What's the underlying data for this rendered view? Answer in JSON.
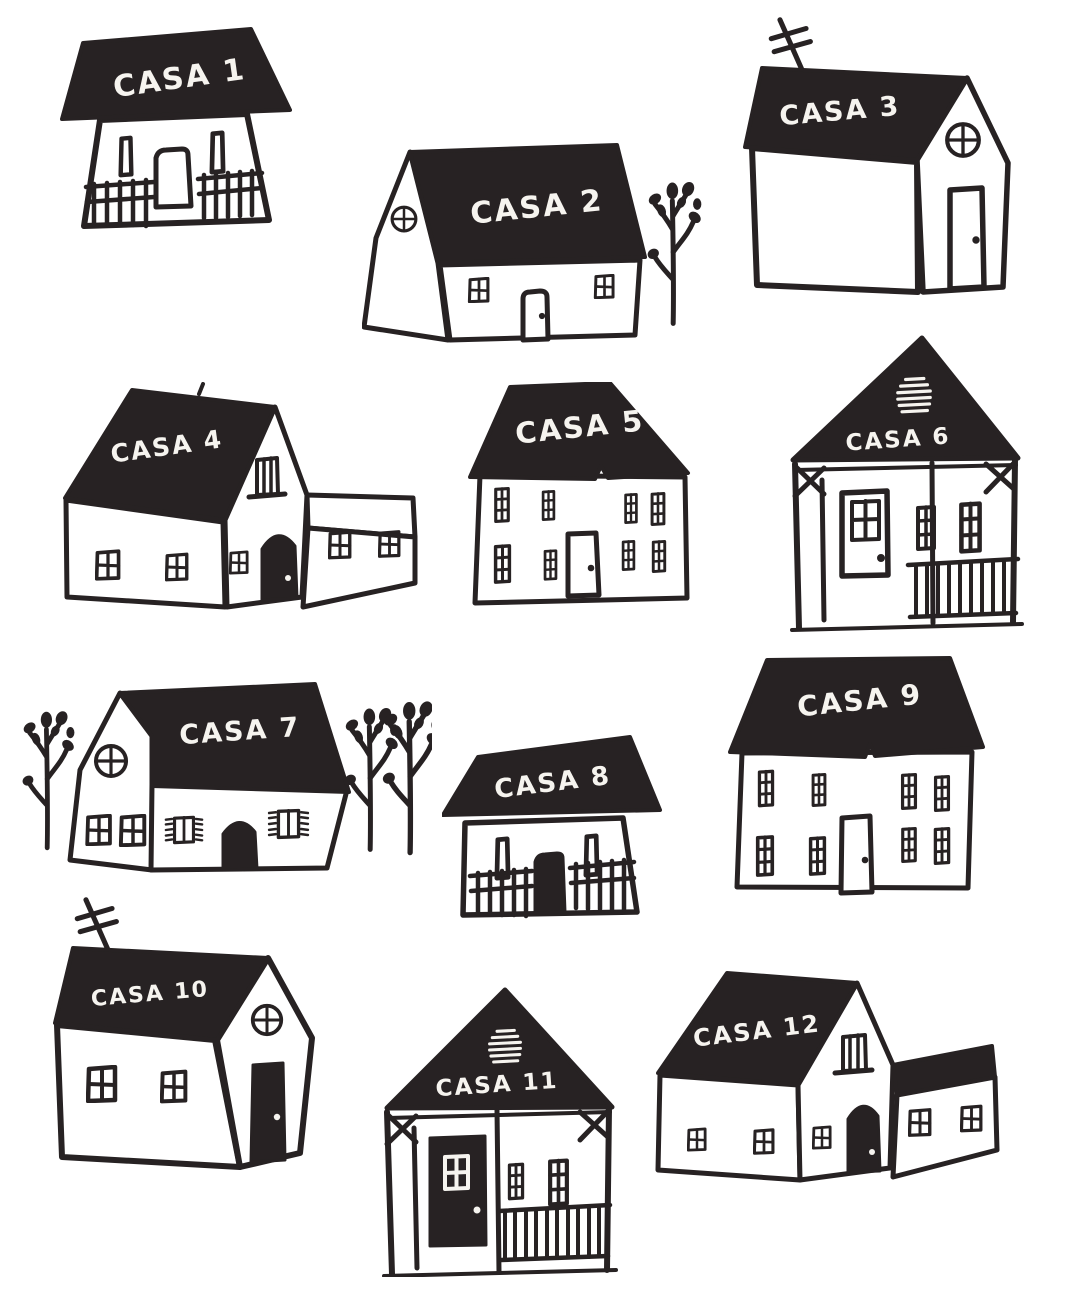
{
  "page": {
    "title": "Hand-drawn houses illustration sheet",
    "background": "#ffffff",
    "ink_color": "#272223",
    "label_color": "#f6f4ef"
  },
  "houses": [
    {
      "label": "CASA 1",
      "features": [
        "gable-roof",
        "porch-railing",
        "two-slim-windows",
        "door"
      ]
    },
    {
      "label": "CASA 2",
      "features": [
        "round-gable-window",
        "two-cross-windows",
        "door",
        "tree"
      ]
    },
    {
      "label": "CASA 3",
      "features": [
        "antenna",
        "round-gable-window",
        "door"
      ]
    },
    {
      "label": "CASA 4",
      "features": [
        "attic-window",
        "arched-door",
        "side-wing",
        "cross-windows"
      ]
    },
    {
      "label": "CASA 5",
      "features": [
        "two-story",
        "paned-windows",
        "door"
      ]
    },
    {
      "label": "CASA 6",
      "features": [
        "roof-vent",
        "porch-frame",
        "glazed-door",
        "tall-windows",
        "railing"
      ]
    },
    {
      "label": "CASA 7",
      "features": [
        "round-gable-window",
        "shuttered-windows",
        "arched-door",
        "trees"
      ]
    },
    {
      "label": "CASA 8",
      "features": [
        "gable-roof",
        "porch-railing",
        "two-slim-windows",
        "solid-door"
      ]
    },
    {
      "label": "CASA 9",
      "features": [
        "two-story",
        "paned-windows",
        "door"
      ]
    },
    {
      "label": "CASA 10",
      "features": [
        "antenna",
        "round-gable-window",
        "solid-door",
        "cross-windows"
      ]
    },
    {
      "label": "CASA 11",
      "features": [
        "roof-vent",
        "porch-frame",
        "solid-glazed-door",
        "tall-windows",
        "railing"
      ]
    },
    {
      "label": "CASA 12",
      "features": [
        "attic-window",
        "arched-door",
        "side-wing",
        "cross-windows"
      ]
    }
  ]
}
